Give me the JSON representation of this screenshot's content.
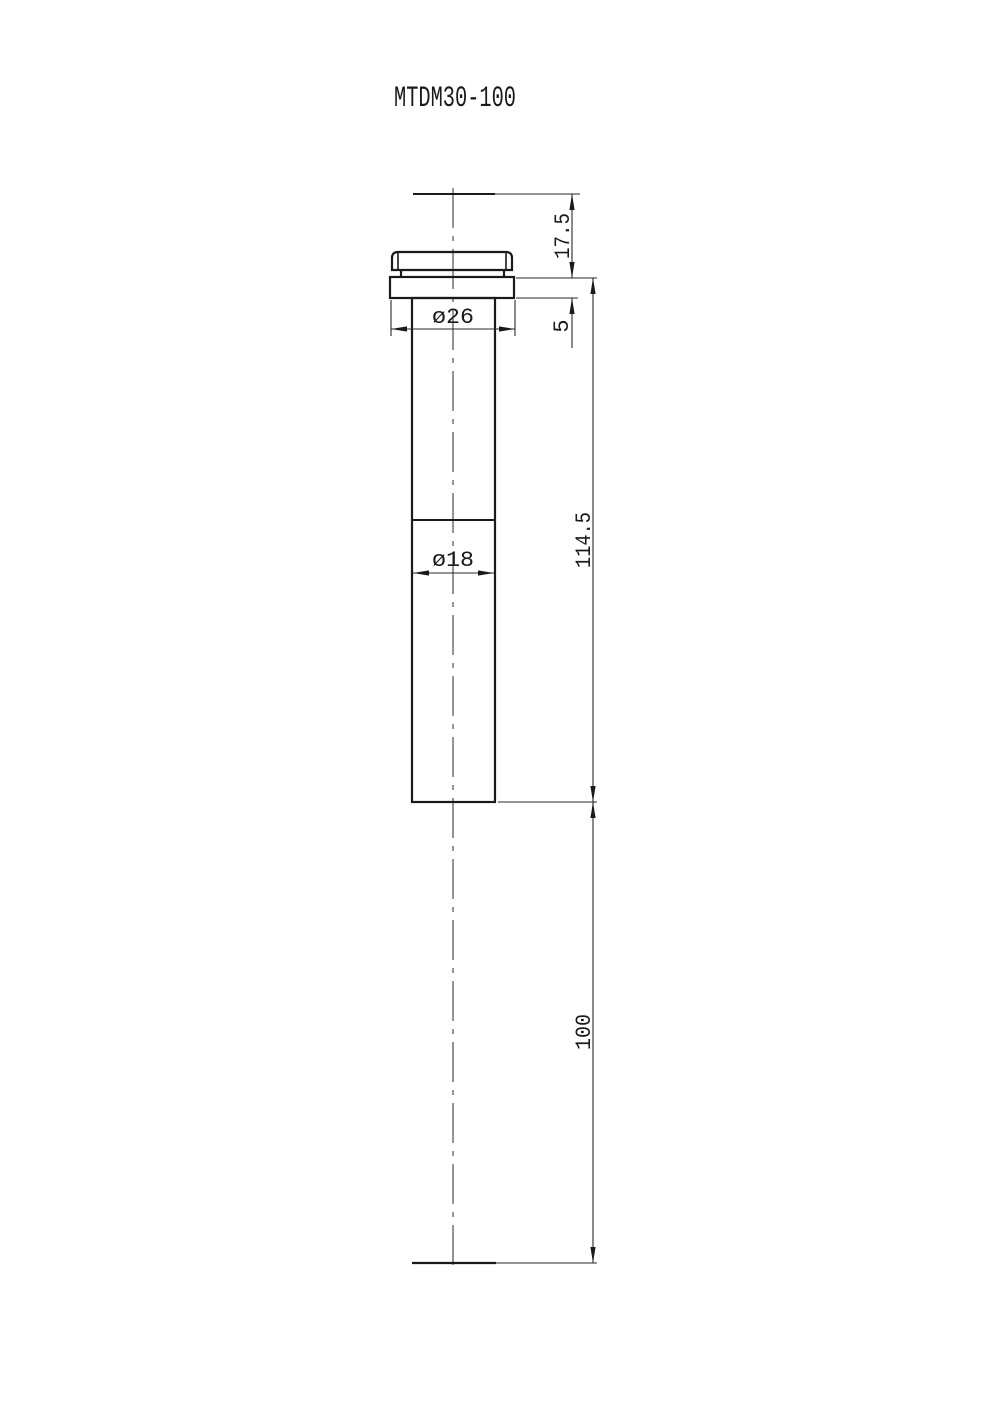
{
  "title": "MTDM30-100",
  "colors": {
    "line": "#1a1a1a",
    "background": "#ffffff"
  },
  "dimensions": {
    "top_clearance": "17.5",
    "flange_thickness": "5",
    "body_length": "114.5",
    "travel": "100",
    "flange_diameter": "ø26",
    "body_diameter": "ø18"
  }
}
